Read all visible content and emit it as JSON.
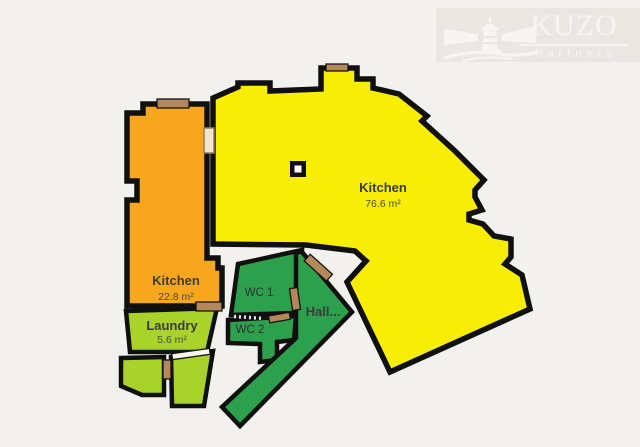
{
  "brand": {
    "name": "KUZO",
    "tagline": "Partners",
    "logo_color": "#f7f5f1",
    "banner_color": "#eae7e2"
  },
  "rooms": {
    "kitchen_large": {
      "label": "Kitchen",
      "area": "76.6 m²",
      "color": "#f8ee05"
    },
    "kitchen_small": {
      "label": "Kitchen",
      "area": "22.8 m²",
      "color": "#f7a71d"
    },
    "laundry": {
      "label": "Laundry",
      "area": "5.6 m²",
      "color": "#a9d32a"
    },
    "wc1": {
      "label": "WC 1",
      "color": "#2da04d"
    },
    "wc2": {
      "label": "WC 2",
      "color": "#2da04d"
    },
    "hall": {
      "label": "Hall...",
      "color": "#2da04d"
    },
    "store_left": {
      "color": "#a9d32a"
    },
    "store_right": {
      "color": "#a9d32a"
    }
  },
  "canvas": {
    "background": "#f2f1ee",
    "wall_color": "#101010"
  }
}
